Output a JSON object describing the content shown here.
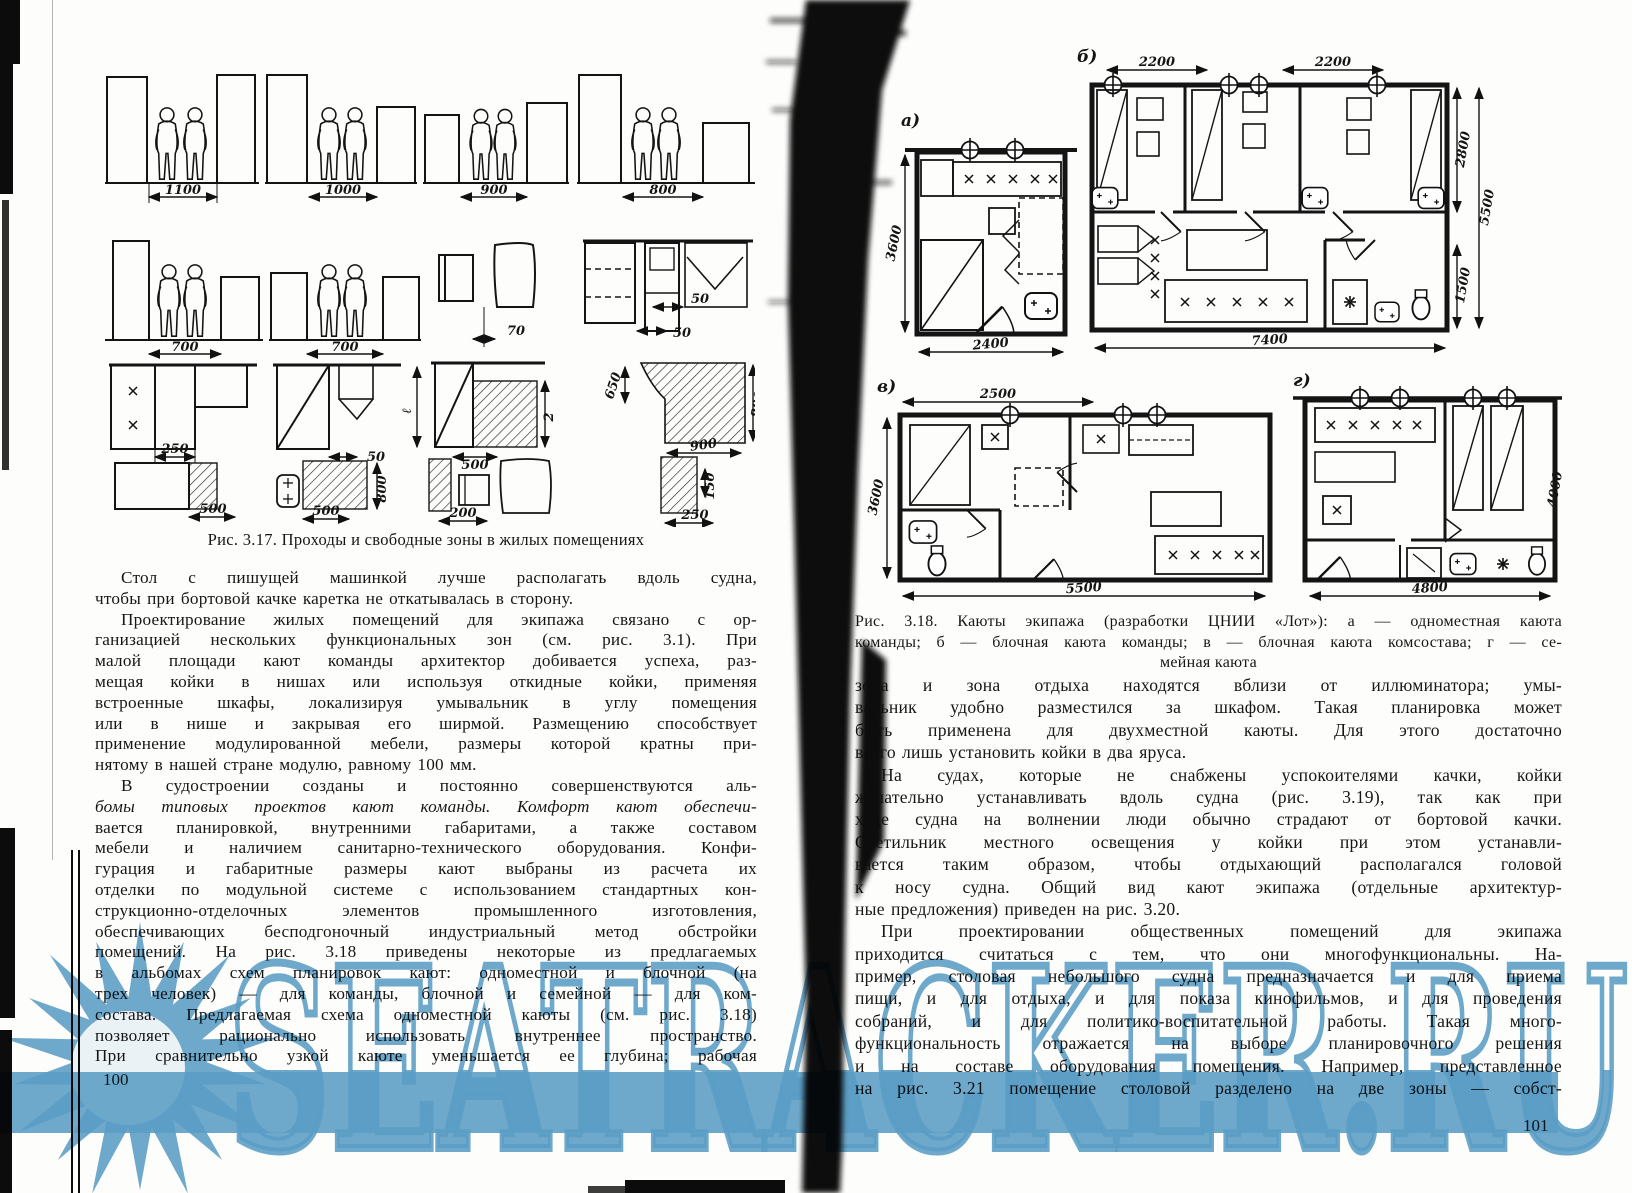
{
  "watermark": {
    "text": "SEATRACKER.RU",
    "color": "#5b9ec8"
  },
  "left_page": {
    "page_number": "100",
    "figure": {
      "caption": "Рис. 3.17. Проходы и свободные зоны в жилых помещениях",
      "dims": {
        "r1c1": "1100",
        "r1c2": "1000",
        "r1c3": "900",
        "r1c4": "800",
        "r2c1": "700",
        "r2c2": "700",
        "r2c3": "70",
        "r2c4a": "50",
        "r2c4b": "50",
        "r3c1": "250",
        "r3c2": "50",
        "r3c3": "500",
        "r3c3l": "ℓ",
        "r3c3r": "2",
        "r3c4a": "650",
        "r3c4b": "800",
        "r3c4c": "900",
        "r4c1": "500",
        "r4c2a": "800",
        "r4c2b": "500",
        "r4c3": "200",
        "r4c4a": "150",
        "r4c4b": "250"
      }
    },
    "lines": [
      "Стол с пишущей машинкой лучше располагать вдоль судна,",
      "чтобы при бортовой качке каретка не откатывалась в сторону.",
      "Проектирование жилых помещений для экипажа связано с ор-",
      "ганизацией нескольких функциональных зон (см. рис. 3.1). При",
      "малой площади кают команды архитектор добивается успеха, раз-",
      "мещая койки в нишах или используя откидные койки, применяя",
      "встроенные шкафы, локализируя умывальник в углу помещения",
      "или в нише и закрывая его ширмой. Размещению способствует",
      "применение модулированной мебели, размеры которой кратны при-",
      "нятому в нашей стране модулю, равному 100 мм.",
      "В судостроении созданы и постоянно совершенствуются аль-",
      "бомы типовых проектов кают команды. Комфорт кают обеспечи-",
      "вается планировкой, внутренними габаритами, а также составом",
      "мебели и наличием санитарно-технического оборудования. Конфи-",
      "гурация и габаритные размеры кают выбраны из расчета их",
      "отделки по модульной системе с использованием стандартных кон-",
      "струкционно-отделочных элементов промышленного изготовления,",
      "обеспечивающих бесподгоночный индустриальный метод обстройки",
      "помещений. На рис. 3.18 приведены некоторые из предлагаемых",
      "в альбомах схем планировок кают: одноместной и блочной (на",
      "трех человек) — для команды, блочной и семейной — для ком-",
      "состава. Предлагаемая схема одноместной каюты (см. рис. 3.18)",
      "позволяет рационально использовать внутреннее пространство.",
      "При сравнительно узкой каюте уменьшается ее глубина; рабочая"
    ]
  },
  "right_page": {
    "page_number": "101",
    "figure": {
      "caption_lines": [
        "Рис. 3.18. Каюты экипажа (разработки ЦНИИ «Лот»): а — одноместная каюта",
        "команды; б — блочная каюта команды; в — блочная каюта комсостава; г — се-",
        "мейная каюта"
      ],
      "labels": {
        "a": "а)",
        "b": "б)",
        "v": "в)",
        "g": "г)"
      },
      "dims": {
        "a_h": "3600",
        "a_w": "2400",
        "b_top1": "2200",
        "b_top2": "2200",
        "b_right1": "2800",
        "b_right2": "5500",
        "b_right3": "1500",
        "b_bottom": "7400",
        "v_top": "2500",
        "v_h": "3600",
        "v_bottom": "5500",
        "g_right": "4000",
        "g_bottom": "4800"
      }
    },
    "lines": [
      "зона и зона отдыха находятся вблизи от иллюминатора; умы-",
      "вальник удобно разместился за шкафом. Такая планировка может",
      "быть применена для двухместной каюты. Для этого достаточно",
      "всего лишь установить койки в два яруса.",
      "На судах, которые не снабжены успокоителями качки, койки",
      "желательно устанавливать вдоль судна (рис. 3.19), так как при",
      "ходе судна на волнении люди обычно страдают от бортовой качки.",
      "Светильник местного освещения у койки при этом устанавли-",
      "вается таким образом, чтобы отдыхающий располагался головой",
      "к носу судна. Общий вид кают экипажа (отдельные архитектур-",
      "ные предложения) приведен на рис. 3.20.",
      "При проектировании общественных помещений для экипажа",
      "приходится считаться с тем, что они многофункциональны. На-",
      "пример, столовая небольшого судна предназначается и для приема",
      "пищи, и для отдыха, и для показа кинофильмов, и для проведения",
      "собраний, и для политико-воспитательной работы. Такая много-",
      "функциональность отражается на выборе планировочного решения",
      "и на составе оборудования помещения. Например, представленное",
      "на рис. 3.21 помещение столовой разделено на две зоны — собст-"
    ]
  }
}
